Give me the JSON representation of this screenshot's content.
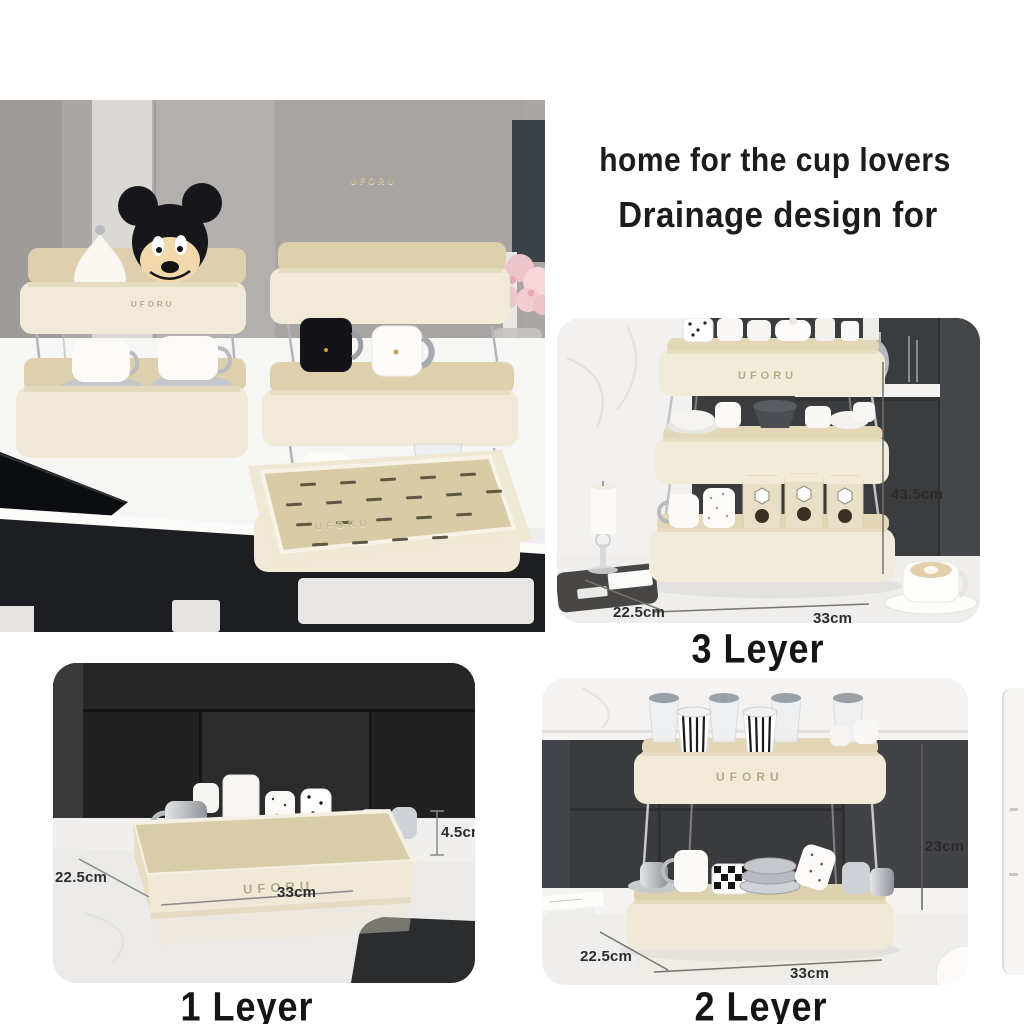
{
  "heading": {
    "line1": "home for the cup lovers",
    "line2": "Drainage design for"
  },
  "brand": "UFORU",
  "photos": {
    "kitchen": {
      "brand_rack_top": "UFORU",
      "brand_rack_left": "UFORU",
      "brand_tray": "UFORU"
    },
    "three_layer": {
      "caption": "3 Leyer",
      "dim_height": "43.5cm",
      "dim_depth": "22.5cm",
      "dim_width": "33cm",
      "brand": "UFORU"
    },
    "one_layer": {
      "caption": "1 Leyer",
      "dim_height": "4.5cm",
      "dim_depth": "22.5cm",
      "dim_width": "33cm",
      "brand": "UFORU"
    },
    "two_layer": {
      "caption": "2 Leyer",
      "dim_height": "23cm",
      "dim_depth": "22.5cm",
      "dim_width": "33cm",
      "brand": "UFORU"
    }
  },
  "colors": {
    "cream": "#f1ead8",
    "tray_tan": "#d9cda9",
    "charcoal": "#3a3b3d",
    "panel_black": "#212121",
    "marble": "#efeeec",
    "counter_white": "#f6f6f5",
    "rose_pink": "#f2cad1",
    "silver": "#c0c3c8"
  }
}
